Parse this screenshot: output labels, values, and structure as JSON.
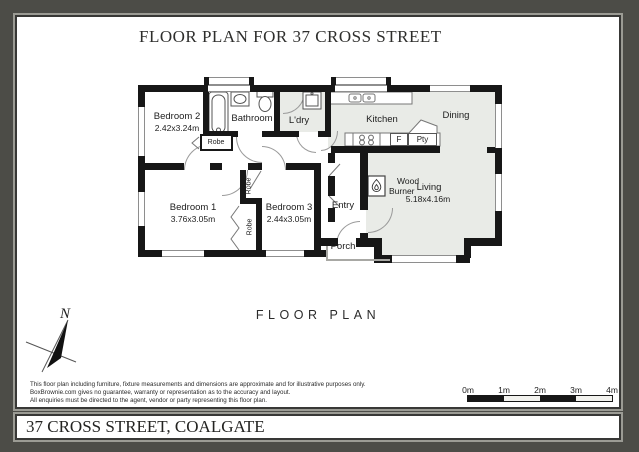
{
  "title": "FLOOR PLAN FOR 37 CROSS STREET",
  "plan_caption": "FLOOR PLAN",
  "footer_address": "37 CROSS STREET, COALGATE",
  "north_label": "N",
  "rooms": {
    "bedroom2": {
      "name": "Bedroom 2",
      "dims": "2.42x3.24m"
    },
    "bathroom": {
      "name": "Bathroom"
    },
    "ldry": {
      "name": "L'dry"
    },
    "kitchen": {
      "name": "Kitchen"
    },
    "dining": {
      "name": "Dining"
    },
    "bedroom1": {
      "name": "Bedroom 1",
      "dims": "3.76x3.05m"
    },
    "bedroom3": {
      "name": "Bedroom 3",
      "dims": "2.44x3.05m"
    },
    "living": {
      "name": "Living",
      "dims": "5.18x4.16m"
    },
    "entry": {
      "name": "Entry"
    },
    "porch": {
      "name": "Porch"
    },
    "wood_burner_line1": "Wood",
    "wood_burner_line2": "Burner"
  },
  "fixtures": {
    "robe": "Robe",
    "fridge": "F",
    "pantry": "Pty"
  },
  "scale_bar": {
    "ticks": [
      "0m",
      "1m",
      "2m",
      "3m",
      "4m"
    ]
  },
  "disclaimer": {
    "line1": "This floor plan including furniture, fixture measurements and dimensions are approximate and for illustrative purposes only.",
    "line2": "BoxBrownie.com gives no guarantee, warranty or representation as to the accuracy and layout.",
    "line3": "All enquiries must be directed to the agent, vendor or party representing this floor plan."
  },
  "colors": {
    "frame": "#4c4c47",
    "wall": "#171717",
    "floor_gray": "#e9ebe7"
  }
}
